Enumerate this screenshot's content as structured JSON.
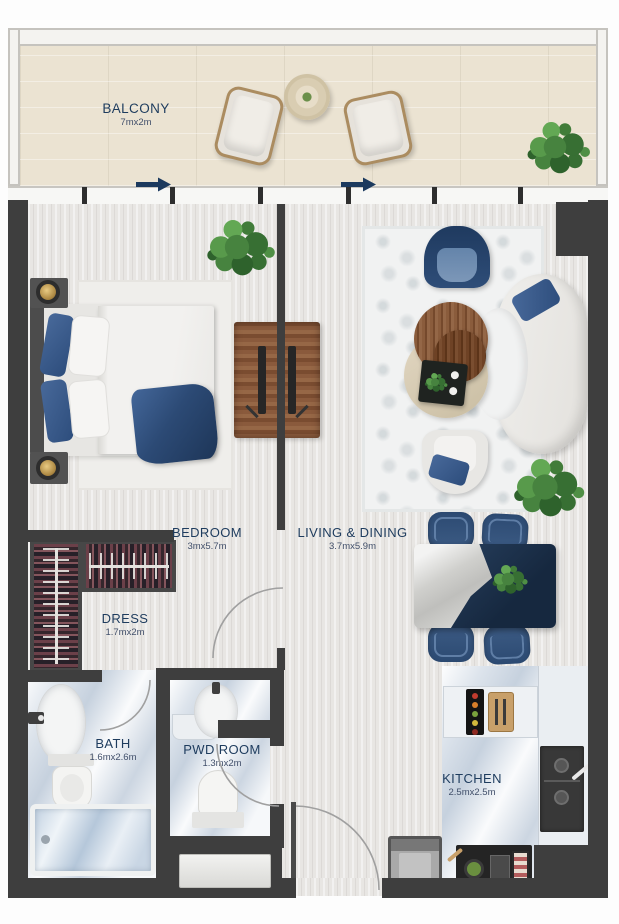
{
  "plan": {
    "type": "apartment floor plan",
    "rooms": {
      "balcony": {
        "label": "BALCONY",
        "dims": "7mx2m"
      },
      "bedroom": {
        "label": "BEDROOM",
        "dims": "3mx5.7m"
      },
      "living_dining": {
        "label": "LIVING & DINING",
        "dims": "3.7mx5.9m"
      },
      "dress": {
        "label": "DRESS",
        "dims": "1.7mx2m"
      },
      "bath": {
        "label": "BATH",
        "dims": "1.6mx2.6m"
      },
      "pwd_room": {
        "label": "PWD ROOM",
        "dims": "1.3mx2m"
      },
      "kitchen": {
        "label": "KITCHEN",
        "dims": "2.5mx2.5m"
      }
    },
    "palette": {
      "wall": "#3e3e3e",
      "label_text": "#1e3c5e",
      "navy_furniture": "#33517a",
      "wood_floor": "#e8e6e3",
      "balcony_floor": "#ebe3d2",
      "marble_floor": "#dde4ec",
      "wood_furniture": "#8a5a3c",
      "plant_green": "#47833f"
    },
    "annotations": {
      "sliding_door_arrow_count": 2,
      "door_swing_arc_count": 4
    }
  }
}
